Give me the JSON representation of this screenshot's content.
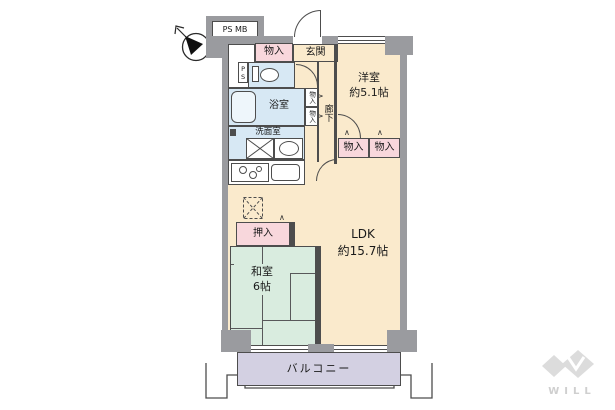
{
  "floor_plan": {
    "utility": {
      "ps_mb": "PS MB",
      "ps": "PS"
    },
    "rooms": {
      "entrance": {
        "label": "玄関"
      },
      "hallway": {
        "label": "廊下"
      },
      "bathroom": {
        "label": "浴室"
      },
      "washroom": {
        "label": "洗面室"
      },
      "western_room": {
        "label": "洋室",
        "size": "約5.1帖"
      },
      "ldk": {
        "label": "LDK",
        "size": "約15.7帖"
      },
      "japanese_room": {
        "label": "和室",
        "size": "6帖"
      },
      "balcony": {
        "label": "バルコニー"
      }
    },
    "storage": {
      "monoiri": "物入",
      "oshiire": "押入"
    },
    "markers": {
      "bifold": "∧"
    }
  },
  "branding": {
    "logo_text": "WILL"
  },
  "colors": {
    "wall_gray": "#9a9b9f",
    "line": "#4d4d4d",
    "room_peach": "#faeacc",
    "storage_pink": "#f8d7dc",
    "wet_area_blue": "#d7e8f4",
    "tatami_green": "#d9ecdf",
    "balcony_lavender": "#d3d0e2",
    "logo_gray": "#cfcfcf"
  }
}
